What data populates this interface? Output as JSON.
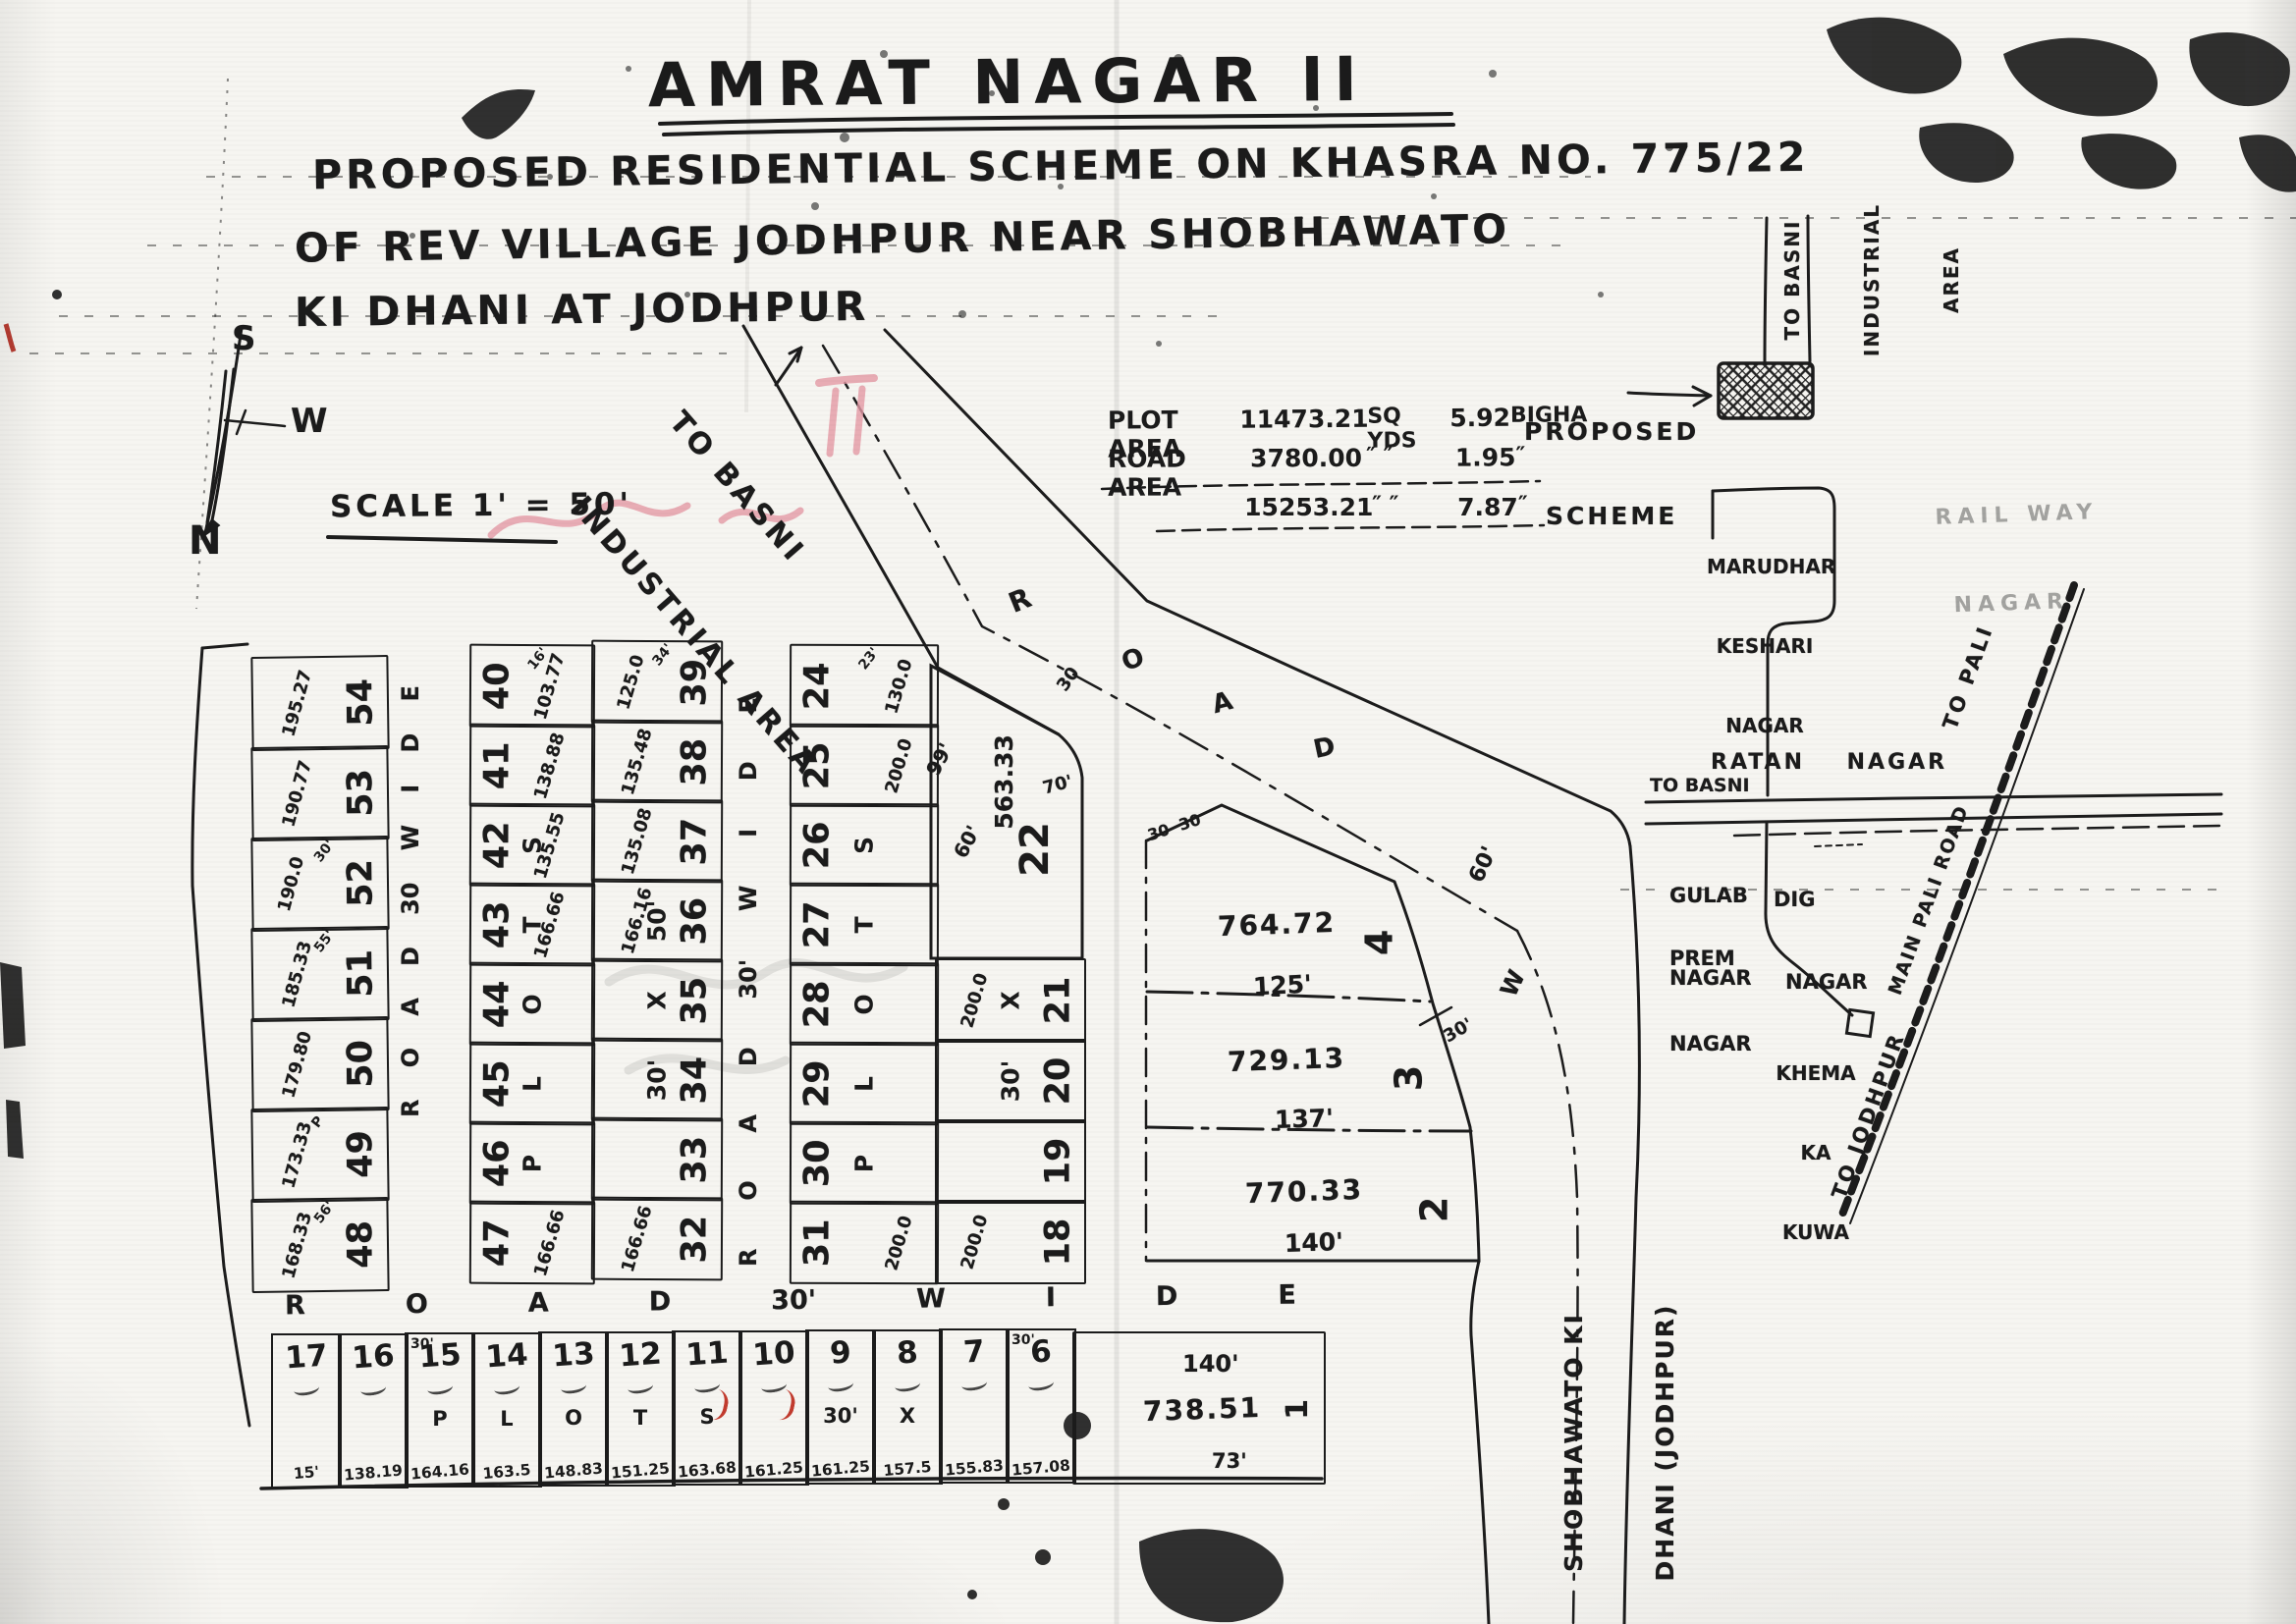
{
  "colors": {
    "ink": "#1b1b1b",
    "paper": "#f6f5f1",
    "red_pen": "#c23b2e",
    "pink_bleed": "#e59aa6"
  },
  "title": {
    "line1": "AMRAT NAGAR II",
    "line2": "PROPOSED RESIDENTIAL SCHEME ON KHASRA NO. 775/22",
    "line3": "OF REV VILLAGE JODHPUR NEAR SHOBHAWATO",
    "line4": "KI DHANI AT JODHPUR"
  },
  "compass": {
    "south": "S",
    "west": "W",
    "north": "N"
  },
  "scale": {
    "text": "SCALE 1' = 50'"
  },
  "area_table": {
    "rows": [
      {
        "label": "PLOT AREA",
        "value": "11473.21",
        "unit": "SQ YDS",
        "bigha": "5.92",
        "bigha_unit": "BIGHA"
      },
      {
        "label": "ROAD AREA",
        "value": "3780.00",
        "unit": "″  ″",
        "bigha": "1.95",
        "bigha_unit": "″"
      },
      {
        "label": "",
        "value": "15253.21",
        "unit": "″  ″",
        "bigha": "7.87",
        "bigha_unit": "″"
      }
    ]
  },
  "proposed_scheme": {
    "line1": "PROPOSED",
    "line2": "SCHEME"
  },
  "roads": {
    "to_basni_diag": [
      "TO BASNI",
      "INDUSTRIAL AREA"
    ],
    "to_basni_vertical": [
      "TO BASNI",
      "INDUSTRIAL",
      "AREA"
    ],
    "spread1": [
      "R",
      "O",
      "A",
      "D",
      "30",
      "W",
      "I",
      "D",
      "E"
    ],
    "spread2": [
      "R",
      "O",
      "A",
      "D",
      "30'",
      "W",
      "I",
      "D",
      "E"
    ],
    "spread3": [
      "R",
      "O",
      "A",
      "D",
      "30'",
      "W",
      "I",
      "D",
      "E"
    ],
    "diag_letters": [
      "R",
      "O",
      "A",
      "D"
    ],
    "diag_marks": [
      "30",
      "30  30"
    ],
    "right_marks": [
      "60'",
      "W",
      "30'"
    ],
    "shobhawato": [
      "SHOBHAWATO KI",
      "DHANI (JODHPUR)"
    ]
  },
  "sketch": {
    "marudhar": [
      "MARUDHAR",
      "KESHARI",
      "NAGAR"
    ],
    "railway": [
      "RAIL WAY",
      "NAGAR"
    ],
    "ratan": "RATAN    NAGAR",
    "to_basni": "TO BASNI",
    "gulab": [
      "GULAB",
      "NAGAR"
    ],
    "dig": [
      "DIG",
      "NAGAR"
    ],
    "prem": [
      "PREM",
      "NAGAR"
    ],
    "khema": [
      "KHEMA",
      "KA",
      "KUWA"
    ],
    "to_pali": "TO PALI",
    "main_road": "MAIN PALI ROAD",
    "to_jodhpur": "TO JODHPUR"
  },
  "scheme": {
    "columns": [
      {
        "id": "A",
        "cells": [
          {
            "n": "54",
            "a": "195.27"
          },
          {
            "n": "53",
            "a": "190.77"
          },
          {
            "n": "52",
            "a": "190.0",
            "m": "30'"
          },
          {
            "n": "51",
            "a": "185.33",
            "m": "55'"
          },
          {
            "n": "50",
            "a": "179.80"
          },
          {
            "n": "49",
            "a": "173.33",
            "m": "P"
          },
          {
            "n": "48",
            "a": "168.33",
            "m": "56'"
          }
        ]
      },
      {
        "id": "B",
        "cells": [
          {
            "n": "40",
            "a": "103.77",
            "m": "16'"
          },
          {
            "n": "41",
            "a": "138.88"
          },
          {
            "n": "42",
            "a": "135.55",
            "l": "S"
          },
          {
            "n": "43",
            "a": "166.66",
            "l": "T"
          },
          {
            "n": "44",
            "l": "O"
          },
          {
            "n": "45",
            "l": "L"
          },
          {
            "n": "46",
            "l": "P"
          },
          {
            "n": "47",
            "a": "166.66"
          }
        ]
      },
      {
        "id": "C",
        "cells": [
          {
            "n": "39",
            "a": "125.0",
            "m": "34'"
          },
          {
            "n": "38",
            "a": "135.48"
          },
          {
            "n": "37",
            "a": "135.08"
          },
          {
            "n": "36",
            "a": "166.16",
            "l": "50'"
          },
          {
            "n": "35",
            "l": "X"
          },
          {
            "n": "34",
            "l": "30'"
          },
          {
            "n": "33"
          },
          {
            "n": "32",
            "a": "166.66"
          }
        ]
      },
      {
        "id": "D",
        "cells": [
          {
            "n": "24",
            "a": "130.0",
            "m": "23'"
          },
          {
            "n": "25",
            "a": "200.0"
          },
          {
            "n": "26",
            "l": "S"
          },
          {
            "n": "27",
            "l": "T"
          },
          {
            "n": "28",
            "l": "O"
          },
          {
            "n": "29",
            "l": "L"
          },
          {
            "n": "30",
            "l": "P"
          },
          {
            "n": "31",
            "a": "200.0"
          }
        ]
      },
      {
        "id": "E",
        "cells": [
          {
            "n": "21",
            "a": "200.0",
            "l": "X"
          },
          {
            "n": "20",
            "l": "30'"
          },
          {
            "n": "19"
          },
          {
            "n": "18",
            "a": "200.0"
          }
        ]
      }
    ],
    "plot22": {
      "n": "22",
      "a": "563.33",
      "d1": "99'",
      "d2": "60'",
      "d3": "70'"
    },
    "big_plots": [
      {
        "n": "4",
        "a": "764.72",
        "w": "125'"
      },
      {
        "n": "3",
        "a": "729.13",
        "w": "137'"
      },
      {
        "n": "2",
        "a": "770.33",
        "w": "140'"
      }
    ],
    "plot1": {
      "n": "1",
      "a": "738.51",
      "top": "140'",
      "bottom": "73'"
    },
    "bottom_row": [
      {
        "n": "17",
        "a": "15'"
      },
      {
        "n": "16",
        "a": "138.19"
      },
      {
        "n": "15",
        "a": "164.16",
        "l": "P",
        "m": "30'"
      },
      {
        "n": "14",
        "a": "163.5",
        "l": "L"
      },
      {
        "n": "13",
        "a": "148.83",
        "l": "O"
      },
      {
        "n": "12",
        "a": "151.25",
        "l": "T"
      },
      {
        "n": "11",
        "a": "163.68",
        "l": "S",
        "red": true
      },
      {
        "n": "10",
        "a": "161.25",
        "red": true
      },
      {
        "n": "9",
        "a": "161.25",
        "l": "30'"
      },
      {
        "n": "8",
        "a": "157.5",
        "l": "X"
      },
      {
        "n": "7",
        "a": "155.83"
      },
      {
        "n": "6",
        "a": "157.08",
        "m": "30'"
      }
    ]
  }
}
